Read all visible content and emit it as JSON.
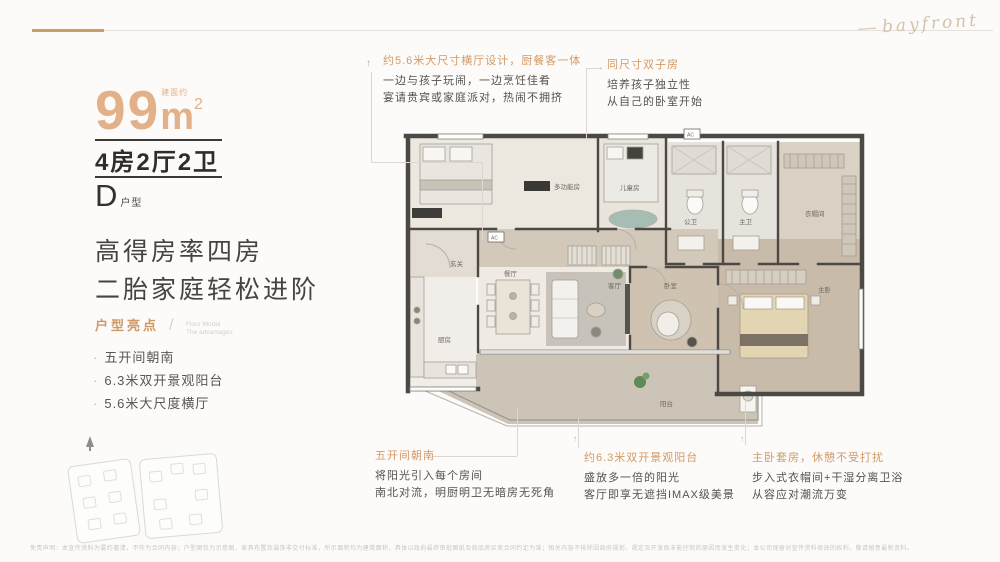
{
  "logo": {
    "script_text": "bayfront"
  },
  "left_panel": {
    "area": {
      "prefix": "建面约",
      "number": "99",
      "unit": "m",
      "sup": "2"
    },
    "layout": "4房2厅2卫",
    "type_letter": "D",
    "type_suffix": "户型",
    "headline_line1": "高得房率四房",
    "headline_line2": "二胎家庭轻松进阶",
    "highlights_title": "户型亮点",
    "highlights_sub1": "Floor Model",
    "highlights_sub2": "The advantages",
    "bullets": [
      "五开间朝南",
      "6.3米双开景观阳台",
      "5.6米大尺度横厅"
    ]
  },
  "annotations": [
    {
      "title": "约5.6米大尺寸横厅设计，厨餐客一体",
      "line1": "一边与孩子玩闹，一边烹饪佳肴",
      "line2": "宴请贵宾或家庭派对，热闹不拥挤"
    },
    {
      "title": "同尺寸双子房",
      "line1": "培养孩子独立性",
      "line2": "从自己的卧室开始"
    },
    {
      "title": "五开间朝南",
      "line1": "将阳光引入每个房间",
      "line2": "南北对流，明厨明卫无暗房无死角"
    },
    {
      "title": "约6.3米双开景观阳台",
      "line1": "盛放多一倍的阳光",
      "line2": "客厅即享无遮挡IMAX级美景"
    },
    {
      "title": "主卧套房，休憩不受打扰",
      "line1": "步入式衣帽间+干湿分离卫浴",
      "line2": "从容应对潮流万变"
    }
  ],
  "floorplan": {
    "rooms": {
      "multi": "多功能房",
      "kids": "儿童房",
      "bath_public": "公卫",
      "bath_master": "主卫",
      "closet": "衣帽间",
      "entry": "玄关",
      "kitchen": "厨房",
      "dining": "餐厅",
      "living": "客厅",
      "bedroom2": "卧室",
      "master": "主卧",
      "balcony": "阳台"
    },
    "ac": "AC"
  },
  "colors": {
    "accent": "#cf9a64",
    "wall": "#4c4944",
    "area_orange": "#e2b189"
  },
  "footer": {
    "disclaimer": "免责声明：本宣传资料为要约邀请，不作为合同内容；户型图仅为示意图，家具布置及装饰非交付标准，所示面积均为建筑面积，具体以政府最终审批图纸及商品房买卖合同约定为准；相关内容不排除因政府规划、规定及开发商未能控制的原因而发生变化；本公司保留对宣传资料修改的权利，敬请留意最新资料。"
  }
}
